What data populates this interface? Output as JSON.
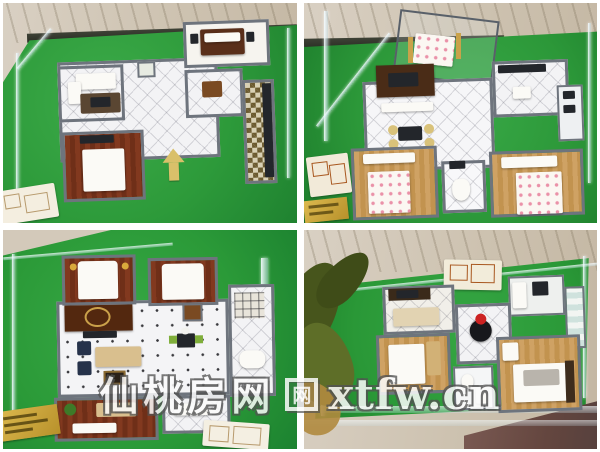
{
  "collage": {
    "kind": "photo-collage 2x2 of miniature apartment scale models in glass display cases",
    "frame_color": "#ffffff"
  },
  "watermark": {
    "site_name": "仙桃房网",
    "logo_glyph": "网",
    "domain": "xtfw.cn",
    "text_color": "#fcfcfc",
    "outline_color": "#525252"
  },
  "palette": {
    "turf_green": "#2f9e3c",
    "turf_dark": "#1f7f2e",
    "wall_gray": "#6e747d",
    "marble_beige": "#d6cabb",
    "marble_brown": "#6f4f4b",
    "wood_oak": "#c89a5e",
    "wood_redbrown": "#7c3a22",
    "tv_wall_brown": "#4a2c17",
    "glass_tint": "#dceef3",
    "plaque_gold": "#c9a436",
    "accent_red": "#cc2222",
    "arrow_tan": "#d9c06a"
  }
}
